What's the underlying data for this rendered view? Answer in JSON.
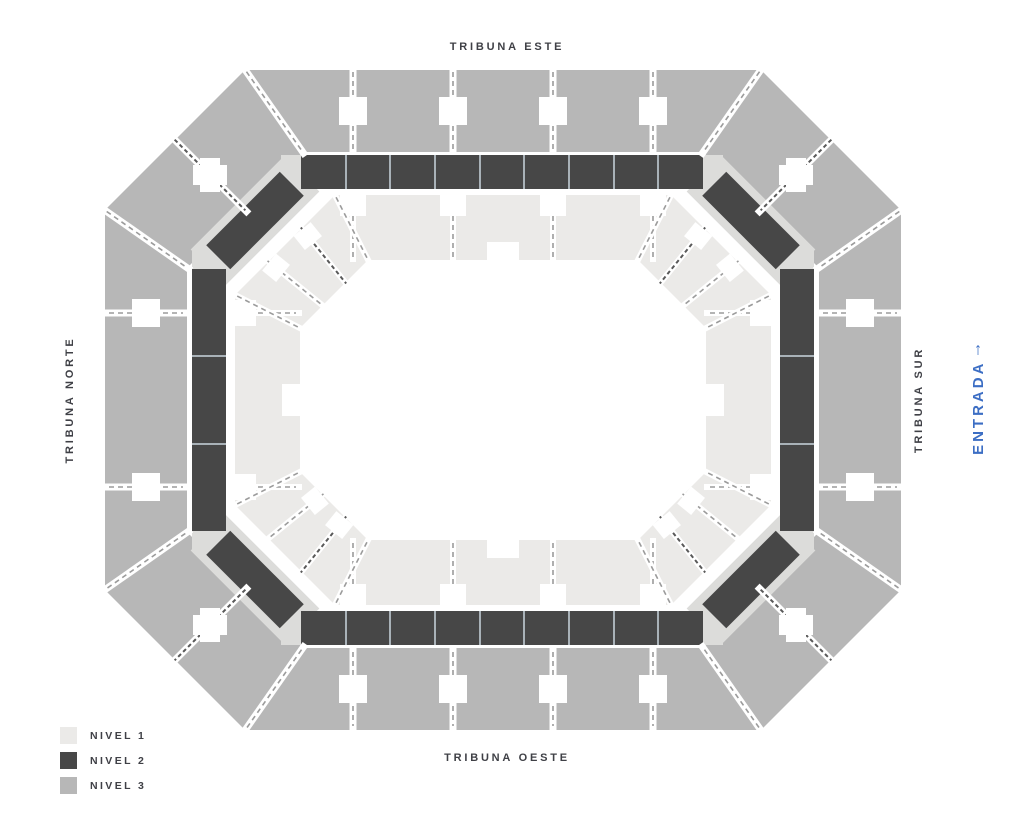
{
  "labels": {
    "top": "TRIBUNA ESTE",
    "bottom": "TRIBUNA OESTE",
    "left": "TRIBUNA NORTE",
    "right": "TRIBUNA SUR"
  },
  "entrance": {
    "label": "ENTRADA",
    "arrow": "↑"
  },
  "legend": {
    "items": [
      {
        "label": "NIVEL 1",
        "color": "#ebeae8"
      },
      {
        "label": "NIVEL 2",
        "color": "#474747"
      },
      {
        "label": "NIVEL 3",
        "color": "#b7b7b7"
      }
    ]
  },
  "colors": {
    "nivel1": "#ebeae8",
    "nivel2": "#474747",
    "nivel3": "#b7b7b7",
    "landing": "#dcdcda",
    "separator": "#a9b2b8",
    "dash": "#9b9b9b",
    "dashdark": "#595959",
    "text": "#3f4046",
    "blue": "#3c6ec4",
    "bg": "#ffffff"
  },
  "map": {
    "nivel2_block_counts": {
      "top": 9,
      "bottom": 9,
      "left": 3,
      "right": 3,
      "corner_blocks": 4
    }
  }
}
